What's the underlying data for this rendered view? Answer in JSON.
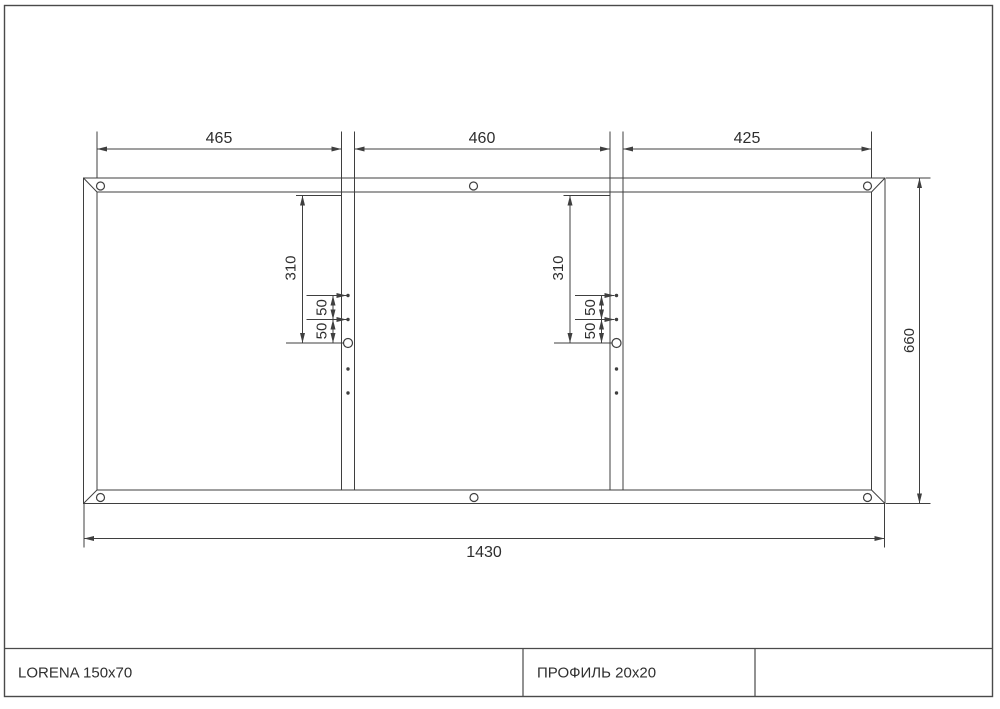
{
  "sheet": {
    "background": "#ffffff",
    "line_color": "#3f3f3f"
  },
  "dims": {
    "seg1": "465",
    "seg2": "460",
    "seg3": "425",
    "width": "1430",
    "height": "660",
    "offset1": "310",
    "gap1a": "50",
    "gap1b": "50",
    "offset2": "310",
    "gap2a": "50",
    "gap2b": "50"
  },
  "title_block": {
    "product": "LORENA 150x70",
    "profile": "ПРОФИЛЬ 20x20",
    "extra": ""
  }
}
